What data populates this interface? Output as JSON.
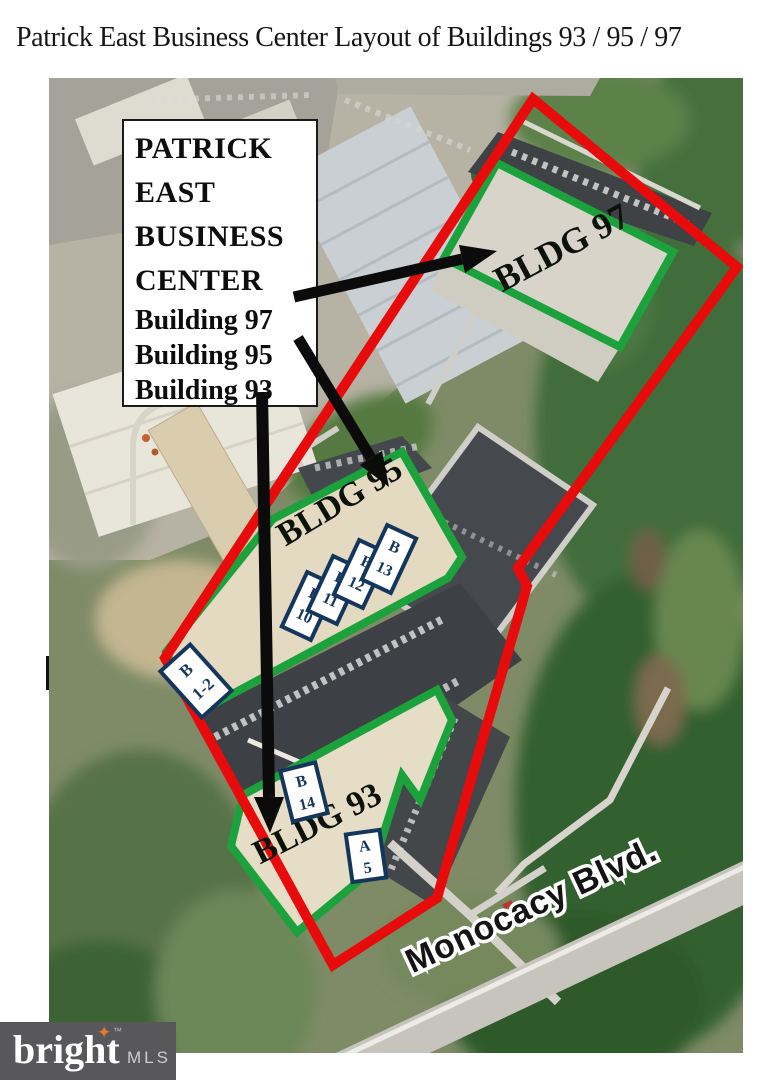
{
  "title": "Patrick East Business Center Layout of Buildings 93 / 95 / 97",
  "info_box": {
    "name_lines": [
      "PATRICK",
      "EAST",
      "BUSINESS",
      "CENTER"
    ],
    "building_lines": [
      "Building 97",
      "Building 95",
      "Building 93"
    ]
  },
  "map": {
    "building_labels": [
      "BLDG 97",
      "BLDG 95",
      "BLDG 93"
    ],
    "street_label": "Monocacy Blvd.",
    "units": [
      {
        "letter": "B",
        "number": "10"
      },
      {
        "letter": "B",
        "number": "11"
      },
      {
        "letter": "B",
        "number": "12"
      },
      {
        "letter": "B",
        "number": "13"
      },
      {
        "letter": "B",
        "number": "1-2"
      },
      {
        "letter": "B",
        "number": "14"
      },
      {
        "letter": "A",
        "number": "5"
      }
    ]
  },
  "logo": {
    "brand": "bright",
    "trademark": "™",
    "suffix": "MLS",
    "star_icon": "✦"
  },
  "colors": {
    "property_outline": "#e80b0b",
    "building_outline": "#1ca23c",
    "unit_box_border": "#14365c",
    "logo_background": "#58585a",
    "logo_star": "#e8762e"
  }
}
